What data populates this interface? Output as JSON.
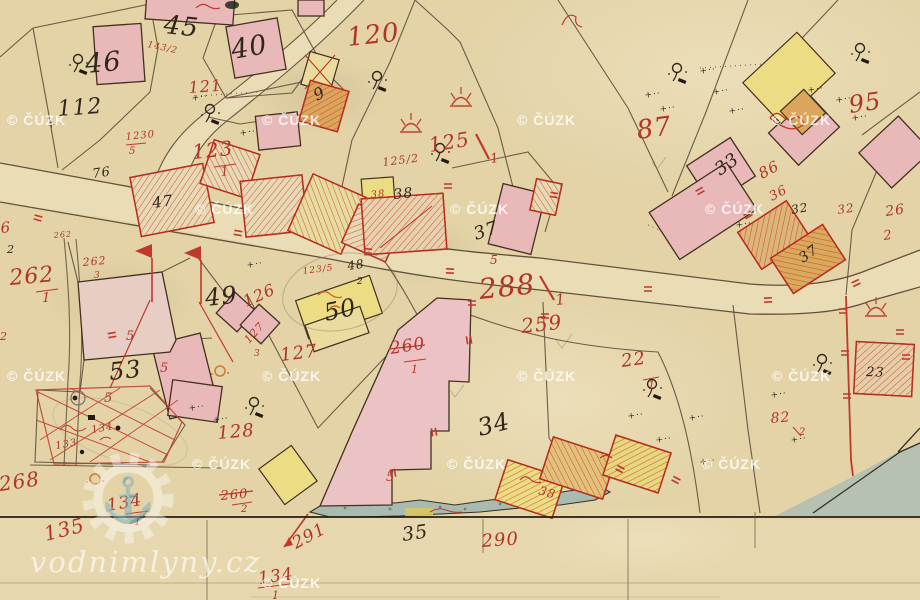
{
  "map": {
    "title": "historical cadastral map sheet",
    "road_parcel_label": "288/1",
    "colors": {
      "paper": "#e3d3a7",
      "road_fill": "#eadcb4",
      "building_pink": "#e9b9ba",
      "building_yellow": "#ecdd85",
      "building_orange": "#dba55c",
      "red_ink": "#b13527",
      "black_ink": "#30271a",
      "water": "#a9bbb1",
      "pond": "#b6c1b1"
    },
    "watermarks": {
      "cuzk": {
        "text": "© ČÚZK",
        "positions": [
          [
            7,
            125
          ],
          [
            262,
            125
          ],
          [
            517,
            125
          ],
          [
            772,
            125
          ],
          [
            195,
            214
          ],
          [
            450,
            214
          ],
          [
            705,
            214
          ],
          [
            7,
            381
          ],
          [
            262,
            381
          ],
          [
            517,
            381
          ],
          [
            772,
            381
          ],
          [
            192,
            469
          ],
          [
            447,
            469
          ],
          [
            702,
            469
          ],
          [
            262,
            588
          ]
        ]
      },
      "site": {
        "text": "vodnimlyny.cz",
        "anchor_icon": "⚓"
      }
    },
    "labels": {
      "red": [
        {
          "t": "120",
          "x": 348,
          "y": 46,
          "s": 26,
          "r": -6
        },
        {
          "t": "121",
          "x": 189,
          "y": 93,
          "s": 16,
          "r": -4
        },
        {
          "t": "123",
          "x": 193,
          "y": 159,
          "s": 20,
          "r": -6
        },
        {
          "t": "1",
          "x": 221,
          "y": 176,
          "s": 13,
          "r": -6
        },
        {
          "t": "1230",
          "x": 126,
          "y": 140,
          "s": 10,
          "r": -6
        },
        {
          "t": "5",
          "x": 129,
          "y": 154,
          "s": 10,
          "r": 0
        },
        {
          "t": "143/2",
          "x": 147,
          "y": 47,
          "s": 9,
          "r": 12
        },
        {
          "t": "125",
          "x": 430,
          "y": 152,
          "s": 20,
          "r": -9
        },
        {
          "t": "1",
          "x": 491,
          "y": 163,
          "s": 13,
          "r": -9
        },
        {
          "t": "125/2",
          "x": 383,
          "y": 166,
          "s": 11,
          "r": -7
        },
        {
          "t": "87",
          "x": 638,
          "y": 139,
          "s": 26,
          "r": -8
        },
        {
          "t": "95",
          "x": 850,
          "y": 113,
          "s": 24,
          "r": -8
        },
        {
          "t": "86",
          "x": 762,
          "y": 179,
          "s": 15,
          "r": -28
        },
        {
          "t": "36",
          "x": 772,
          "y": 201,
          "s": 13,
          "r": -28
        },
        {
          "t": "32",
          "x": 838,
          "y": 214,
          "s": 12,
          "r": -8
        },
        {
          "t": "26",
          "x": 886,
          "y": 216,
          "s": 14,
          "r": -8
        },
        {
          "t": "2",
          "x": 884,
          "y": 240,
          "s": 13,
          "r": -8
        },
        {
          "t": "6",
          "x": 1,
          "y": 233,
          "s": 15,
          "r": -5
        },
        {
          "t": "262",
          "x": 10,
          "y": 285,
          "s": 22,
          "r": -5
        },
        {
          "t": "1",
          "x": 42,
          "y": 302,
          "s": 13,
          "r": 0
        },
        {
          "t": "262",
          "x": 83,
          "y": 266,
          "s": 11,
          "r": -5
        },
        {
          "t": "3",
          "x": 94,
          "y": 278,
          "s": 9,
          "r": 0
        },
        {
          "t": "262",
          "x": 54,
          "y": 238,
          "s": 8,
          "r": -5
        },
        {
          "t": "2",
          "x": 0,
          "y": 340,
          "s": 11,
          "r": 0
        },
        {
          "t": "268",
          "x": 0,
          "y": 491,
          "s": 20,
          "r": -8
        },
        {
          "t": "135",
          "x": 46,
          "y": 541,
          "s": 20,
          "r": -14
        },
        {
          "t": "134",
          "x": 108,
          "y": 511,
          "s": 17,
          "r": -10
        },
        {
          "t": "1",
          "x": 134,
          "y": 525,
          "s": 11,
          "r": 0
        },
        {
          "t": "133",
          "x": 56,
          "y": 449,
          "s": 10,
          "r": -10
        },
        {
          "t": "134",
          "x": 92,
          "y": 433,
          "s": 10,
          "r": -10
        },
        {
          "t": "128",
          "x": 218,
          "y": 439,
          "s": 18,
          "r": -5
        },
        {
          "t": "260",
          "x": 221,
          "y": 500,
          "s": 13,
          "r": -5
        },
        {
          "t": "2",
          "x": 241,
          "y": 512,
          "s": 10,
          "r": 0
        },
        {
          "t": "126",
          "x": 246,
          "y": 307,
          "s": 16,
          "r": -24
        },
        {
          "t": "127",
          "x": 249,
          "y": 344,
          "s": 11,
          "r": -48
        },
        {
          "t": "3",
          "x": 254,
          "y": 356,
          "s": 9,
          "r": 0
        },
        {
          "t": "127",
          "x": 281,
          "y": 361,
          "s": 18,
          "r": -7
        },
        {
          "t": "123/5",
          "x": 303,
          "y": 274,
          "s": 9,
          "r": -7
        },
        {
          "t": "260",
          "x": 391,
          "y": 354,
          "s": 17,
          "r": -9
        },
        {
          "t": "1",
          "x": 411,
          "y": 373,
          "s": 11,
          "r": 0
        },
        {
          "t": "259",
          "x": 522,
          "y": 333,
          "s": 20,
          "r": -6
        },
        {
          "t": "288",
          "x": 480,
          "y": 299,
          "s": 28,
          "r": -6
        },
        {
          "t": "1",
          "x": 556,
          "y": 305,
          "s": 15,
          "r": -6
        },
        {
          "t": "290",
          "x": 482,
          "y": 547,
          "s": 18,
          "r": -4
        },
        {
          "t": "291",
          "x": 296,
          "y": 549,
          "s": 17,
          "r": -28
        },
        {
          "t": "134",
          "x": 259,
          "y": 584,
          "s": 17,
          "r": -8
        },
        {
          "t": "1",
          "x": 272,
          "y": 599,
          "s": 11,
          "r": 0
        },
        {
          "t": "22",
          "x": 622,
          "y": 367,
          "s": 18,
          "r": -8
        },
        {
          "t": "1",
          "x": 648,
          "y": 389,
          "s": 11,
          "r": 0
        },
        {
          "t": "82",
          "x": 771,
          "y": 423,
          "s": 14,
          "r": -5
        },
        {
          "t": "2",
          "x": 799,
          "y": 435,
          "s": 10,
          "r": 0
        },
        {
          "t": "38",
          "x": 371,
          "y": 198,
          "s": 10,
          "r": -6
        },
        {
          "t": "38",
          "x": 538,
          "y": 494,
          "s": 12,
          "r": 16
        },
        {
          "t": "5",
          "x": 126,
          "y": 340,
          "s": 13,
          "r": 0
        },
        {
          "t": "5",
          "x": 160,
          "y": 372,
          "s": 13,
          "r": 0
        },
        {
          "t": "5",
          "x": 104,
          "y": 402,
          "s": 13,
          "r": 0
        },
        {
          "t": "5",
          "x": 386,
          "y": 481,
          "s": 13,
          "r": 0
        },
        {
          "t": "5",
          "x": 490,
          "y": 264,
          "s": 12,
          "r": 0
        }
      ],
      "black": [
        {
          "t": "45",
          "x": 163,
          "y": 33,
          "s": 26,
          "r": 6
        },
        {
          "t": "46",
          "x": 86,
          "y": 73,
          "s": 27,
          "r": -5
        },
        {
          "t": "40",
          "x": 233,
          "y": 59,
          "s": 27,
          "r": -10
        },
        {
          "t": "112",
          "x": 58,
          "y": 116,
          "s": 22,
          "r": -4
        },
        {
          "t": "76",
          "x": 93,
          "y": 178,
          "s": 13,
          "r": -8
        },
        {
          "t": "47",
          "x": 153,
          "y": 208,
          "s": 15,
          "r": -8
        },
        {
          "t": "9",
          "x": 317,
          "y": 101,
          "s": 16,
          "r": -28
        },
        {
          "t": "38",
          "x": 394,
          "y": 199,
          "s": 14,
          "r": -6
        },
        {
          "t": "37",
          "x": 476,
          "y": 240,
          "s": 18,
          "r": -18
        },
        {
          "t": "48",
          "x": 348,
          "y": 270,
          "s": 12,
          "r": -8
        },
        {
          "t": "2",
          "x": 357,
          "y": 284,
          "s": 9,
          "r": 0
        },
        {
          "t": "49",
          "x": 206,
          "y": 306,
          "s": 24,
          "r": -6
        },
        {
          "t": "50",
          "x": 326,
          "y": 321,
          "s": 24,
          "r": -12
        },
        {
          "t": "53",
          "x": 110,
          "y": 380,
          "s": 24,
          "r": -6
        },
        {
          "t": "34",
          "x": 480,
          "y": 436,
          "s": 24,
          "r": -14
        },
        {
          "t": "35",
          "x": 403,
          "y": 541,
          "s": 19,
          "r": -8
        },
        {
          "t": "33",
          "x": 720,
          "y": 176,
          "s": 18,
          "r": -35
        },
        {
          "t": "37",
          "x": 803,
          "y": 263,
          "s": 14,
          "r": -35
        },
        {
          "t": "32",
          "x": 792,
          "y": 214,
          "s": 12,
          "r": -10
        },
        {
          "t": "23",
          "x": 866,
          "y": 376,
          "s": 13,
          "r": 2
        },
        {
          "t": "2",
          "x": 7,
          "y": 253,
          "s": 11,
          "r": 0
        }
      ],
      "plus_marks": [
        [
          192,
          101
        ],
        [
          240,
          136
        ],
        [
          645,
          98
        ],
        [
          700,
          74
        ],
        [
          713,
          95
        ],
        [
          729,
          114
        ],
        [
          808,
          93
        ],
        [
          836,
          103
        ],
        [
          852,
          121
        ],
        [
          628,
          419
        ],
        [
          656,
          443
        ],
        [
          689,
          421
        ],
        [
          771,
          398
        ],
        [
          791,
          443
        ],
        [
          189,
          411
        ],
        [
          213,
          423
        ],
        [
          700,
          465
        ],
        [
          736,
          228
        ],
        [
          660,
          112
        ],
        [
          247,
          268
        ],
        [
          48,
          128
        ]
      ],
      "red_ticks": [
        [
          38,
          218,
          15
        ],
        [
          238,
          233,
          10
        ],
        [
          368,
          251,
          5
        ],
        [
          450,
          271,
          3
        ],
        [
          648,
          289,
          0
        ],
        [
          768,
          300,
          -3
        ],
        [
          856,
          283,
          -25
        ],
        [
          112,
          335,
          -10
        ],
        [
          545,
          316,
          0
        ],
        [
          620,
          469,
          28
        ],
        [
          676,
          480,
          28
        ],
        [
          843,
          311,
          0
        ],
        [
          845,
          353,
          0
        ],
        [
          847,
          396,
          0
        ],
        [
          700,
          191,
          -30
        ],
        [
          748,
          215,
          -30
        ],
        [
          900,
          332,
          0
        ],
        [
          906,
          357,
          0
        ],
        [
          554,
          195,
          10
        ],
        [
          448,
          186,
          0
        ],
        [
          469,
          340,
          80
        ],
        [
          434,
          432,
          80
        ],
        [
          393,
          473,
          80
        ],
        [
          472,
          303,
          0
        ]
      ]
    }
  }
}
